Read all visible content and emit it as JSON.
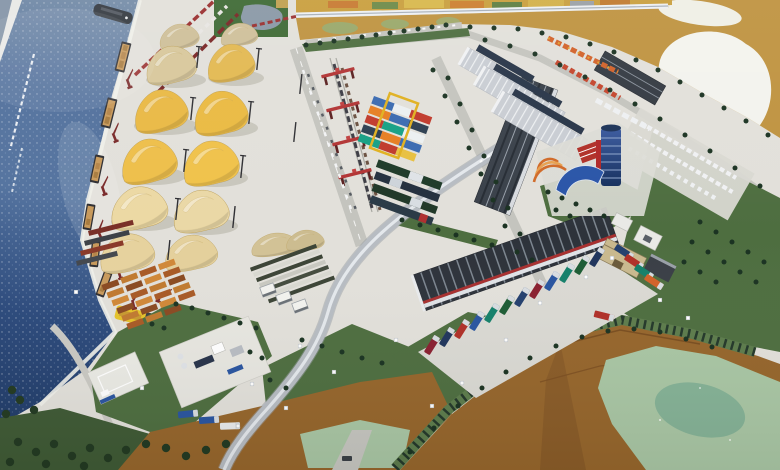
{
  "meta": {
    "type": "photograph",
    "subject": "Scale model (maquette) of a river-port cargo terminal: shipping canal with barges and quay cranes, yellow sulfur stockpiles, rail gantry cranes, container yard, warehouses, truck parks and painted marshland",
    "width_px": 780,
    "height_px": 470
  },
  "palette": {
    "concrete": "#e2e0da",
    "apron": "#dad9d3",
    "water_top": "#768da8",
    "water_mid": "#4f6e9c",
    "water_deep": "#1f3a66",
    "corner_water": "#8595a8",
    "far_bank_white": "#e9e9e6",
    "quay_edge": "#f0efe9",
    "marsh": "#bf9340",
    "marsh_glare": "#f3f3ed",
    "marsh_pond": "#86a88c",
    "marsh_grass": "#9aa86a",
    "backdrop": "#c99f3e",
    "rail_white": "#edf0f3",
    "map_green": "#3f6a35",
    "map_lake": "#8a98a6",
    "sulfur_yellow": "#e9b945",
    "sulfur_khaki": "#cfc09a",
    "sulfur_cream": "#ead8a8",
    "barge_cargo": "#c89a5c",
    "hull_dark": "#2f2f33",
    "tug_yellow": "#e6c32a",
    "ship_gray": "#383d44",
    "crane_maroon": "#7a2a2a",
    "portal_crane_red": "#b23434",
    "wagon_red": "#9a3030",
    "wagon_dark": "#7a2626",
    "wagon_white": "#e8e6e2",
    "lawn": "#4e6e40",
    "lawn_dark": "#3f5a35",
    "tree": "#1b3322",
    "bush": "#233a22",
    "dirt": "#96662c",
    "dirt_dark": "#8a5c28",
    "pond_pale": "#a9c6a4",
    "pond_deep": "#7fae94",
    "road": "#c4c4be",
    "ramp": "#b7bcc2",
    "ramp_sheen": "#e6eaee",
    "wall_green": "#5d7c4c",
    "arch_dark": "#24382a",
    "warehouse_dark": "#2e333b",
    "warehouse_rib": "#8a939e",
    "red_stripe": "#a83030",
    "hall_roof": "#c9cdd3",
    "hall_rib": "#eef0f2",
    "hall_unit": "#283548",
    "container_blue": "#3a6ab0",
    "container_red": "#c0392b",
    "container_orange": "#e67e22",
    "container_teal": "#16a085",
    "container_white": "#ecf0f1",
    "container_navy": "#2c3e50",
    "container_green": "#1e5631",
    "crane_yellow": "#e0b020",
    "truck_orange": "#d2622a",
    "truck_red": "#b03028",
    "truck_navy": "#20355c",
    "truck_blue": "#2a55a0",
    "truck_teal": "#15806a",
    "truck_green": "#1d5c34",
    "truck_darkred": "#8a2030",
    "car_white": "#eef0f2",
    "pallet_brown": "#8a4a22",
    "pallet_orange": "#c07a30",
    "pallet_light": "#d08838",
    "stack_dark": "#3c4436",
    "tower_blue": "#2c4a86",
    "tower_red": "#b02828",
    "canopy_blue": "#2a55a8",
    "fan_orange": "#d06a28",
    "pad_white": "#eaeae4",
    "plaza": "#e7e6e0",
    "service_tan": "#c9b98e",
    "hut_white": "#e9e9e6"
  },
  "objects": [
    "shipping canal with sparkling water",
    "illegible cyrillic inscription along the canal",
    "dark cargo ship",
    "moored barges with bulk cargo",
    "yellow tug boat",
    "maroon quay cranes",
    "railway wagon strings",
    "yellow sulfur stockpiles",
    "brown pallet and timber stacks",
    "red rail-mounted gantry cranes",
    "container yard with yellow crane",
    "tree-lined access roads",
    "white logistics warehouses",
    "dark ribbed warehouse halls",
    "orange truck rows",
    "car parking with white cars",
    "round blue office tower with red fin",
    "blue entrance canopy",
    "curved rail overpass",
    "diagonal row of colored semi-trucks",
    "service buildings",
    "floodlight masts",
    "green lawns with conifer trees",
    "painted marshland with glare ponds",
    "white model-table edge rail"
  ]
}
